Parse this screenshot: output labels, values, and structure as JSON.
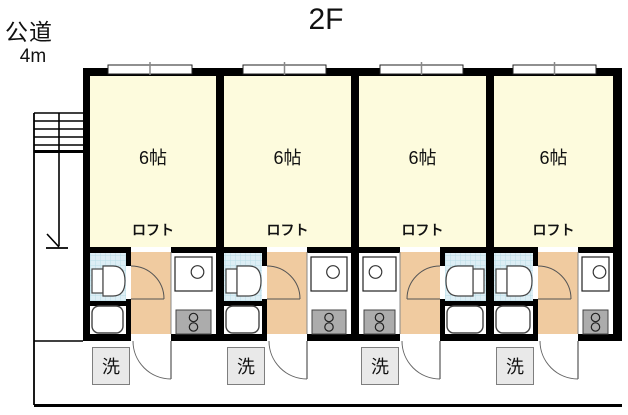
{
  "floor_title": "2F",
  "road": {
    "name": "公道",
    "width": "4m"
  },
  "units": [
    {
      "id": "unit-1",
      "size": "6帖",
      "loft": "ロフト",
      "washer": "洗"
    },
    {
      "id": "unit-2",
      "size": "6帖",
      "loft": "ロフト",
      "washer": "洗"
    },
    {
      "id": "unit-3",
      "size": "6帖",
      "loft": "ロフト",
      "washer": "洗"
    },
    {
      "id": "unit-4",
      "size": "6帖",
      "loft": "ロフト",
      "washer": "洗"
    }
  ],
  "colors": {
    "wall": "#000000",
    "room": "#fdfbdd",
    "hallway": "#f0cba0",
    "tile": "#ddeef5",
    "tile_grid": "#b9dde8",
    "stove": "#acacac",
    "washer_box": "#e9e9e9",
    "fixture_outline": "#444444"
  }
}
